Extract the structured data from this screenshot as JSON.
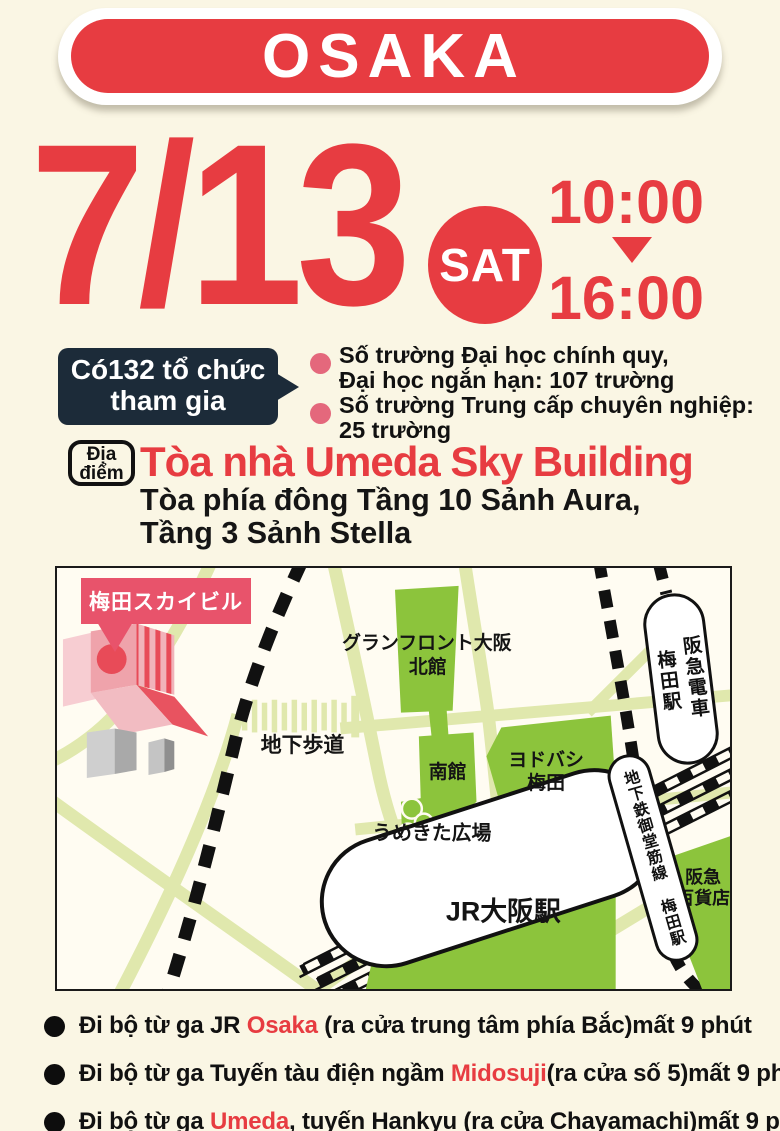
{
  "colors": {
    "background_cream": "#faf6e4",
    "accent_red": "#e73c41",
    "badge_navy": "#1c2b39",
    "bullet_pink": "#e4687c",
    "map_green": "#8cc43c",
    "map_road": "#e0e8ad",
    "sky_label_red": "#e8536b"
  },
  "banner": {
    "title": "OSAKA"
  },
  "schedule": {
    "date": "7/13",
    "day": "SAT",
    "time_start": "10:00",
    "time_end": "16:00"
  },
  "participants": {
    "badge_line1": "Có132 tổ chức",
    "badge_line2": "tham gia",
    "stats": [
      {
        "line1": "Số trường Đại học chính quy,",
        "line2": "Đại học ngắn hạn: 107 trường"
      },
      {
        "line1": "Số trường Trung cấp chuyên nghiệp:",
        "line2": "25 trường"
      }
    ]
  },
  "venue": {
    "badge_line1": "Địa",
    "badge_line2": "điểm",
    "name": "Tòa nhà Umeda Sky Building",
    "detail_line1": "Tòa phía đông Tầng 10 Sảnh Aura,",
    "detail_line2": "Tầng 3 Sảnh Stella"
  },
  "map_labels": {
    "sky_building": "梅田スカイビル",
    "underpass": "地下歩道",
    "grand_front": "グランフロント大阪",
    "north_building": "北館",
    "south_building": "南館",
    "yodobashi_line1": "ヨドバシ",
    "yodobashi_line2": "梅田",
    "umekita_plaza": "うめきた広場",
    "jr_osaka_station": "JR大阪駅",
    "hankyu_station_line1": "阪急電車",
    "hankyu_station_line2": "梅田駅",
    "midosuji_station": "地下鉄御堂筋線 梅田駅",
    "hankyu_dept_line1": "阪急",
    "hankyu_dept_line2": "百貨店"
  },
  "access": {
    "items": [
      {
        "pre": "Đi bộ từ ga JR ",
        "highlight": "Osaka",
        "post": " (ra cửa trung tâm phía Bắc)mất 9 phút"
      },
      {
        "pre": "Đi bộ từ ga Tuyến tàu điện ngầm ",
        "highlight": "Midosuji",
        "post": "(ra cửa số 5)mất 9 phút"
      },
      {
        "pre": "Đi bộ từ ga ",
        "highlight": "Umeda",
        "post": ", tuyến Hankyu (ra cửa Chayamachi)mất 9 phút"
      }
    ]
  }
}
